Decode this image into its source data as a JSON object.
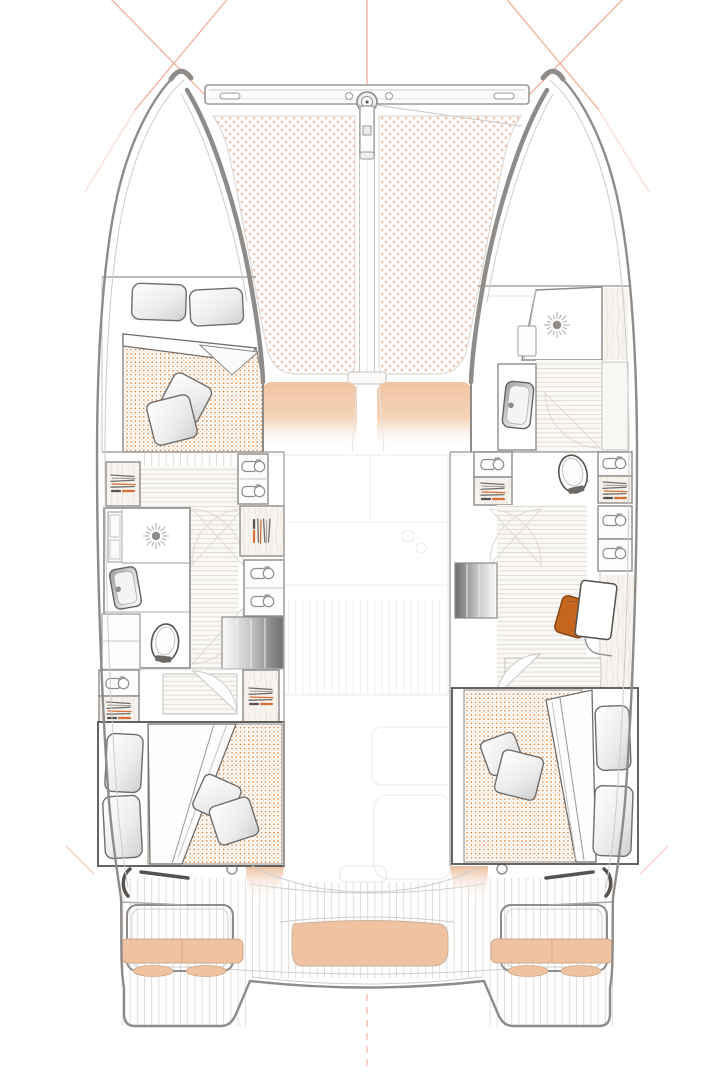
{
  "canvas": {
    "width": 720,
    "height": 1080,
    "background": "#ffffff"
  },
  "drawing": {
    "kind": "catamaran-interior-floor-plan",
    "view": "top-down",
    "text_labels": []
  },
  "colors": {
    "hull_outline": "#8e8b89",
    "inner_line": "#c9c6c3",
    "faint_line": "#e7e4e1",
    "furniture_stroke": "#55524f",
    "trampoline_dot": "#f1bfa6",
    "mattress_dot": "#e78333",
    "mattress_dot_light": "#f6bd92",
    "cushion_tan": "#efc2a1",
    "cushion_edge": "#cfa886",
    "chair_orange": "#c4661d",
    "hanger_orange": "#d96f35",
    "rigging_line": "#efa88e",
    "stairs_dark": "#6f6f6f",
    "wood_line": "#e5dfd8",
    "floor_line": "#dcd8d4",
    "deck_line": "#ded9d5"
  },
  "areas": {
    "foredeck": "trampolines",
    "bow_beam": "crossbeam-with-bowsprit-fitting",
    "forward_cockpit": "sun-cushions",
    "port_forward_cabin": "double-berth",
    "port_head": "shower-sink-toilet",
    "port_companionway": "stairs",
    "port_aft_cabin": "double-berth",
    "starboard_forward_head": "shower-sink-toilet",
    "starboard_desk_area": "desk-with-chair",
    "starboard_companionway": "stairs",
    "starboard_aft_cabin": "double-berth",
    "aft_cockpit": "bench-seat",
    "transoms": "swim-platforms"
  },
  "icons": {
    "shower_light": "sunburst-icon",
    "hanging_locker": "hanging-clothes-icon",
    "shelf_locker": "shelf-roll-icon",
    "toilet": "toilet-icon",
    "sink": "sink-icon"
  }
}
